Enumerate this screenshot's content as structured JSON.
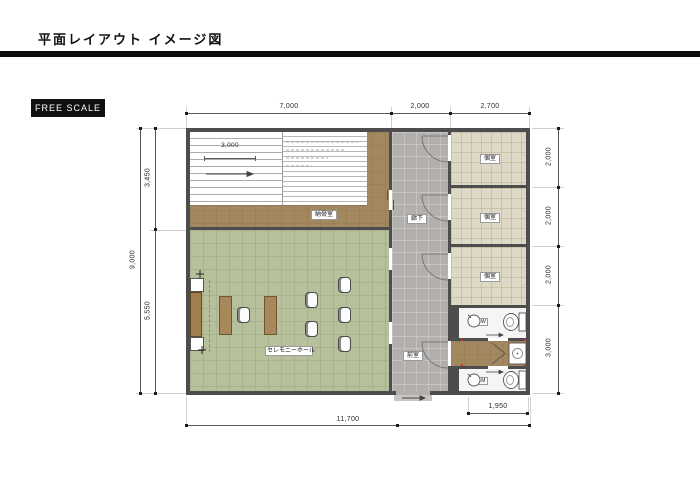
{
  "header": {
    "title": "平面レイアウト イメージ図"
  },
  "badge": {
    "label": "FREE SCALE"
  },
  "rooms": {
    "ossuary": "納骨室",
    "hall": "セレモニーホール",
    "corridor": "廊下",
    "private": "個室",
    "anteroom": "前室",
    "wc_women": "WC.W",
    "wc_men": "WC.M"
  },
  "dims": {
    "top": [
      "7,000",
      "2,000",
      "2,700"
    ],
    "right": [
      "2,000",
      "2,000",
      "2,000",
      "3,000"
    ],
    "left_upper": "3,450",
    "left_lower": "5,550",
    "left_total": "9,000",
    "bottom_total": "11,700",
    "bottom_wc": "1,950",
    "shelf": "3,000"
  },
  "colors": {
    "wall": "#4d4d4d",
    "hall_floor": "#b6c09a",
    "ossuary_floor": "#a3875e",
    "private_floor": "#ded9c6",
    "corridor_floor": "#b2afad",
    "marker_red": "#cc3333"
  }
}
